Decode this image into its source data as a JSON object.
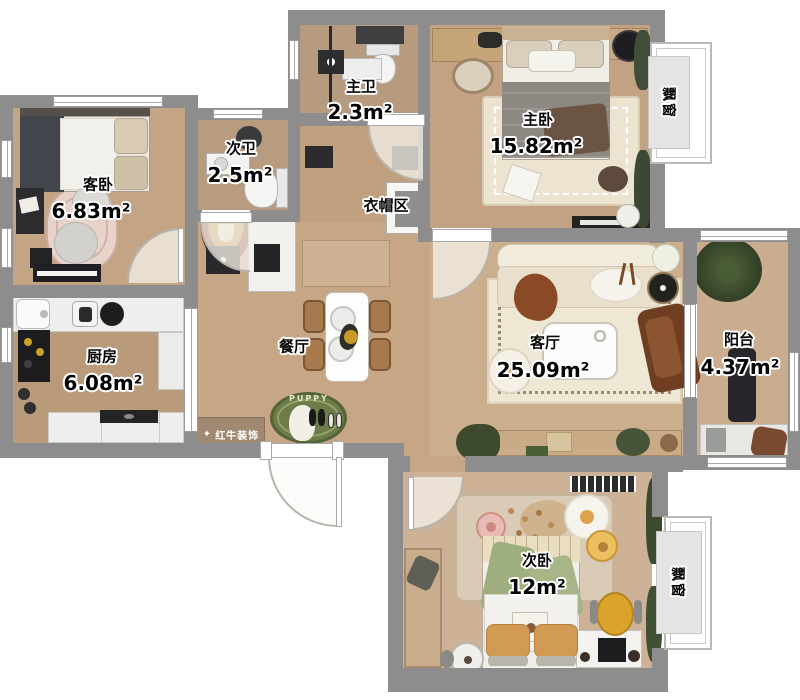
{
  "rooms": {
    "master_bath": {
      "name": "主卫",
      "area": "2.3m²"
    },
    "master_bedroom": {
      "name": "主卧",
      "area": "15.82m²"
    },
    "second_bath": {
      "name": "次卫",
      "area": "2.5m²"
    },
    "guest_bedroom": {
      "name": "客卧",
      "area": "6.83m²"
    },
    "cloakroom": {
      "name": "衣帽区"
    },
    "kitchen": {
      "name": "厨房",
      "area": "6.08m²"
    },
    "dining": {
      "name": "餐厅"
    },
    "living": {
      "name": "客厅",
      "area": "25.09m²"
    },
    "balcony": {
      "name": "阳台",
      "area": "4.37m²"
    },
    "second_bedroom": {
      "name": "次卧",
      "area": "12m²"
    },
    "bay_window_top": {
      "name": "飘窗"
    },
    "bay_window_bottom": {
      "name": "飘窗"
    }
  },
  "branding": {
    "logo_text": "红牛装饰"
  },
  "decor": {
    "puppy_rug_text": "PUPPY"
  },
  "colors": {
    "wall": "#8d8d8d",
    "wood_floor": "#c6a583",
    "rug_green": "#6d7c49",
    "logo_bg": "#a18872"
  }
}
